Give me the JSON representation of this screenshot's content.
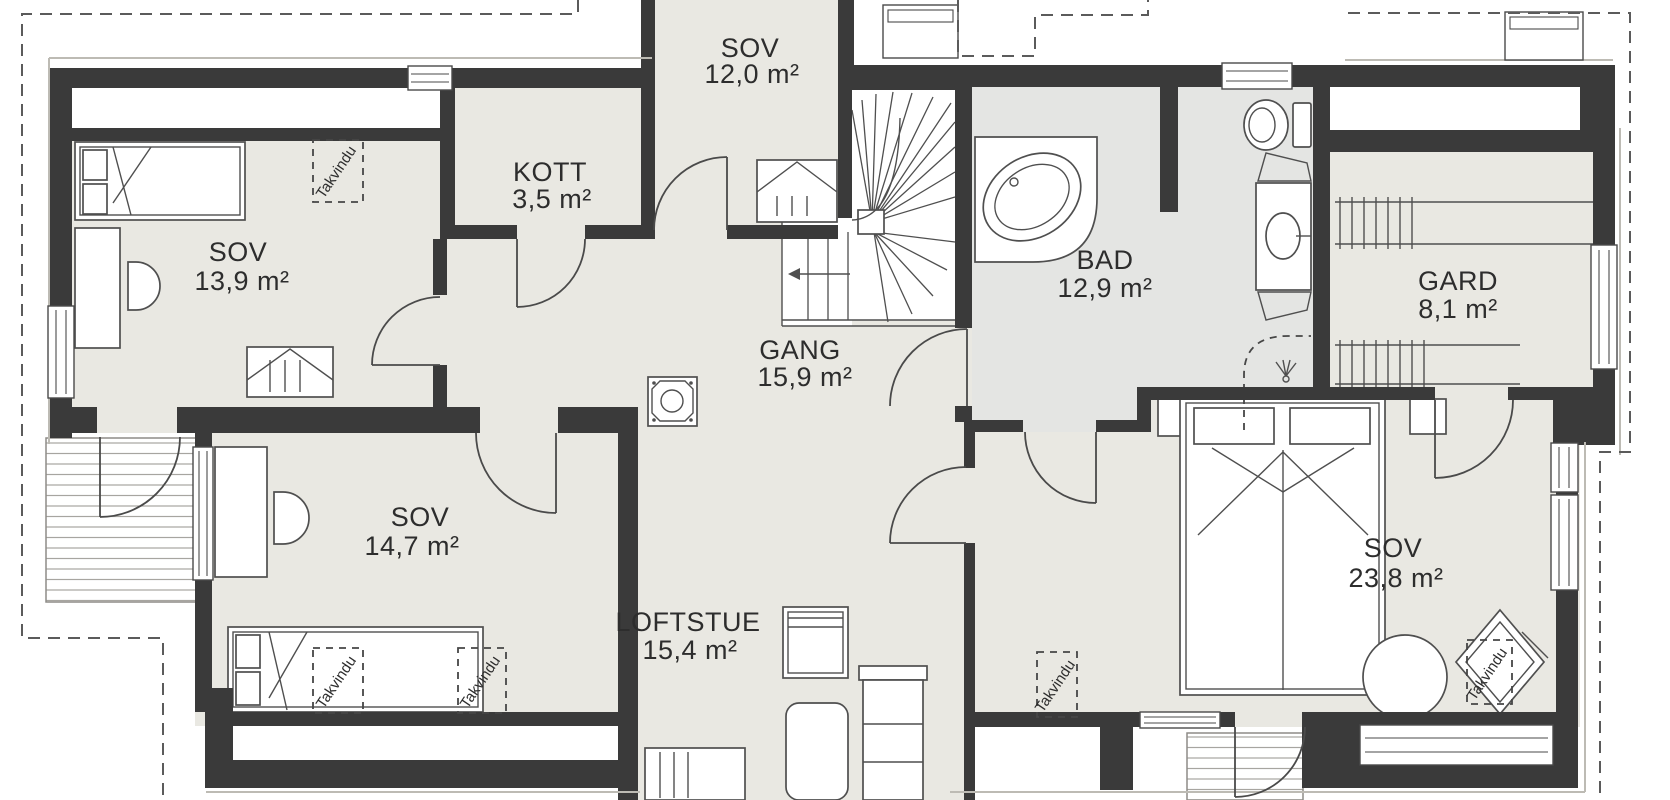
{
  "floorplan": {
    "skylight_label": "Takvindu",
    "rooms": [
      {
        "key": "sov-top",
        "name": "SOV",
        "area": "12,0 m²"
      },
      {
        "key": "kott",
        "name": "KOTT",
        "area": "3,5 m²"
      },
      {
        "key": "sov-left",
        "name": "SOV",
        "area": "13,9 m²"
      },
      {
        "key": "gang",
        "name": "GANG",
        "area": "15,9 m²"
      },
      {
        "key": "bad",
        "name": "BAD",
        "area": "12,9 m²"
      },
      {
        "key": "gard",
        "name": "GARD",
        "area": "8,1 m²"
      },
      {
        "key": "sov-mid",
        "name": "SOV",
        "area": "14,7 m²"
      },
      {
        "key": "loftstue",
        "name": "LOFTSTUE",
        "area": "15,4 m²"
      },
      {
        "key": "sov-right",
        "name": "SOV",
        "area": "23,8 m²"
      }
    ],
    "colors": {
      "wall": "#3a3a3a",
      "floor": "#e9e8e2",
      "floor_bath": "#e4e5e3",
      "roof_dash": "#5b5b5b"
    }
  }
}
